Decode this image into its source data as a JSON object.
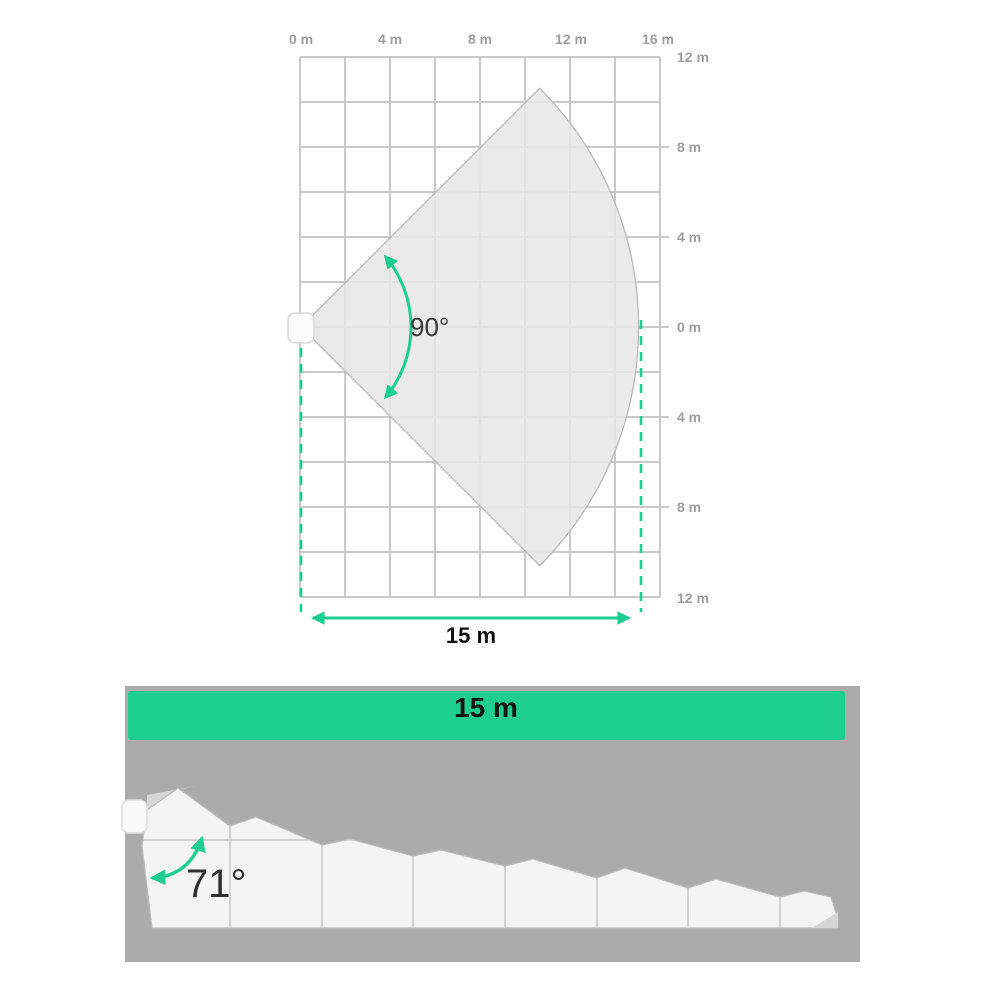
{
  "top_view": {
    "x_axis_labels": [
      "0 m",
      "4 m",
      "8 m",
      "12 m",
      "16 m"
    ],
    "y_axis_labels": [
      "12 m",
      "8 m",
      "4 m",
      "0 m",
      "4 m",
      "8 m",
      "12 m"
    ],
    "angle_label": "90°",
    "width_label": "15 m"
  },
  "side_view": {
    "length_label": "15 m",
    "angle_label": "71°"
  },
  "colors": {
    "accent_green": "#1ecd90",
    "grid_line": "#c9c9c9",
    "axis_label_gray": "#9d9d9d",
    "fan_fill": "#e7e7e7",
    "panel_gray": "#ababab",
    "beam_white": "#f4f4f4",
    "dark_text": "#2f2f2f"
  }
}
